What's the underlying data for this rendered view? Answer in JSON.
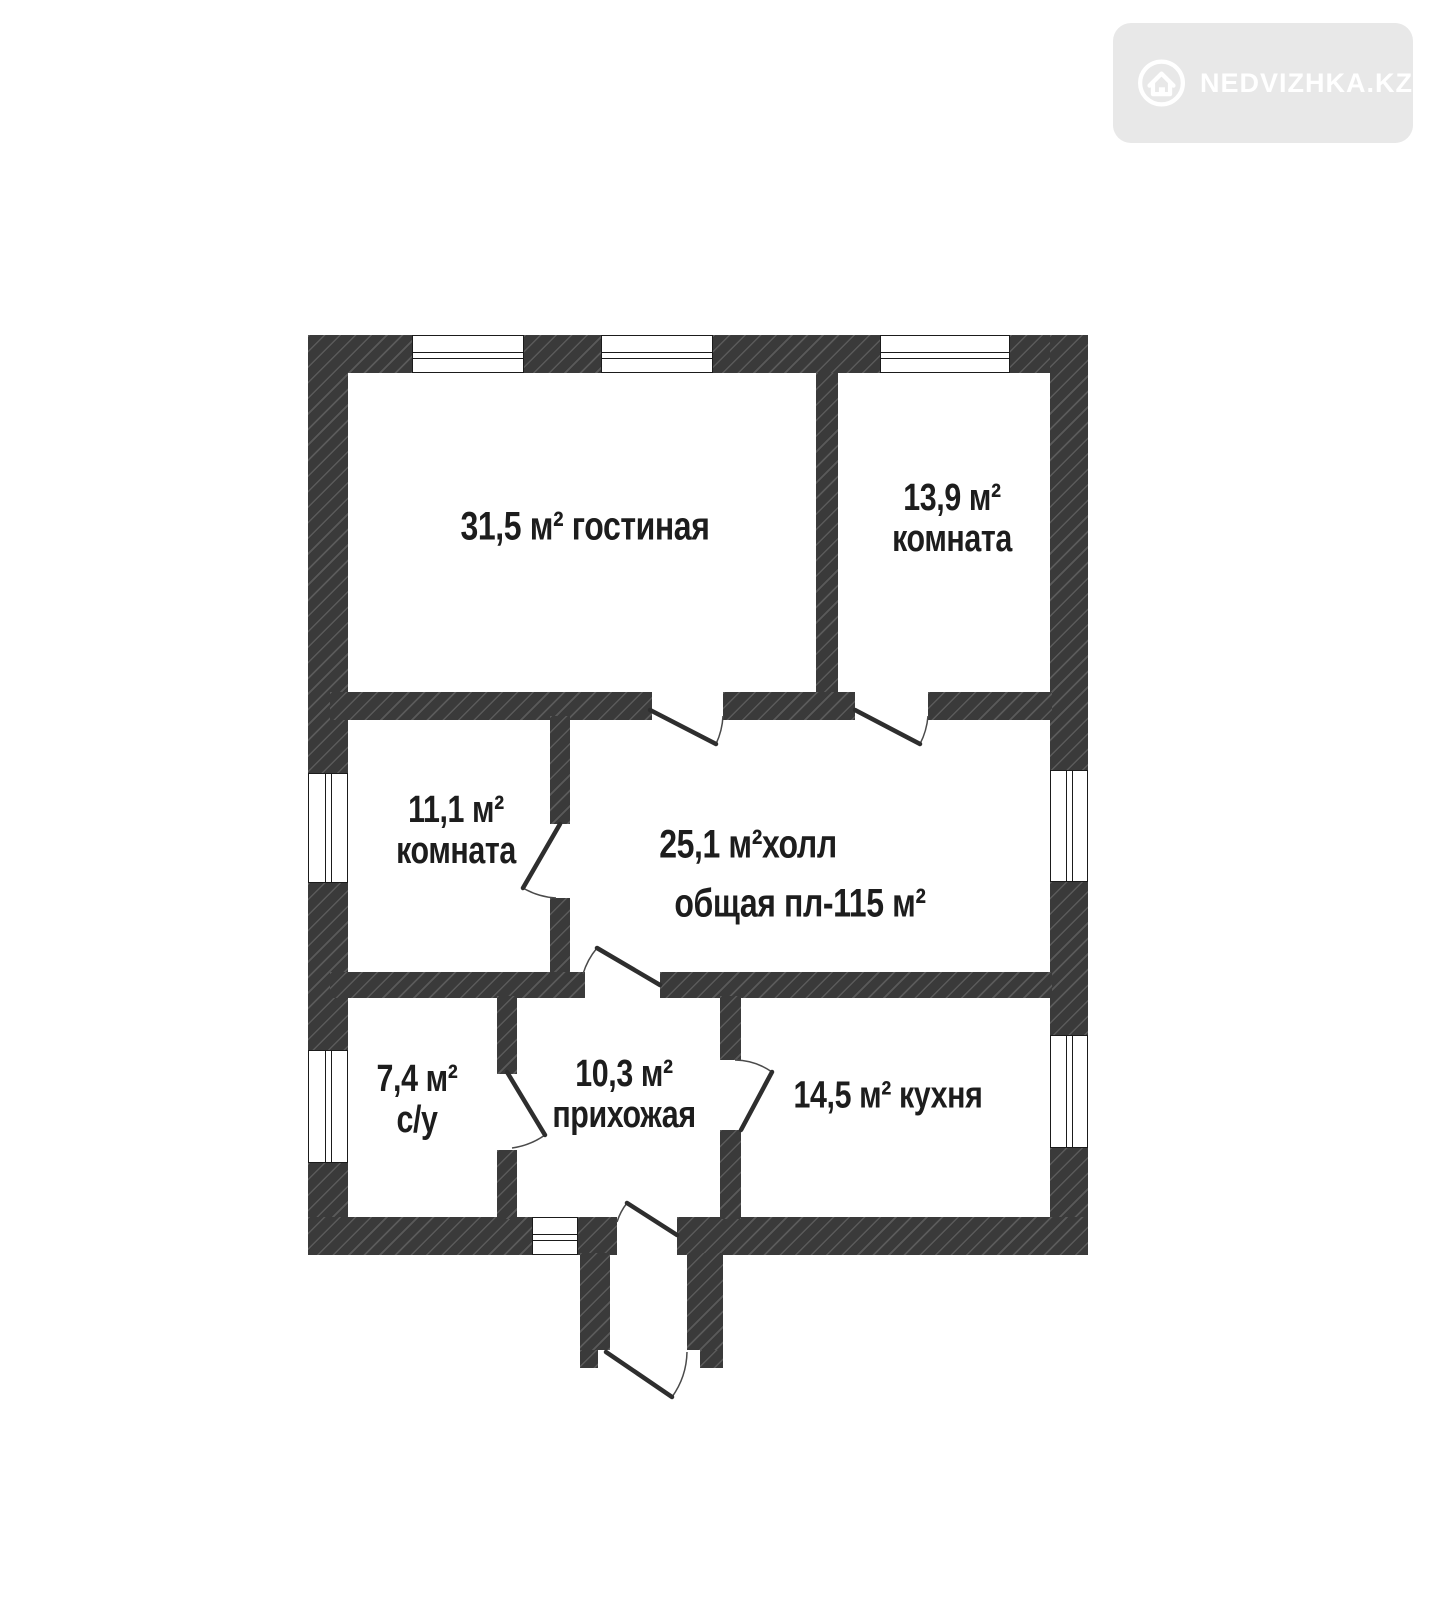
{
  "watermark": {
    "brand": "NEDVIZHKA.KZ",
    "bg_color": "#e8e8e8",
    "fg_color": "#ffffff"
  },
  "floor_plan": {
    "wall_color": "#3a3a3a",
    "total_area_text": "общая пл-115 м²",
    "rooms": [
      {
        "name": "гостиная",
        "area": "31,5 м²",
        "line1": "31,5 м² гостиная"
      },
      {
        "name": "комната",
        "area": "13,9 м²",
        "line1": "13,9 м²",
        "line2": "комната"
      },
      {
        "name": "комната",
        "area": "11,1 м²",
        "line1": "11,1 м²",
        "line2": "комната"
      },
      {
        "name": "холл",
        "area": "25,1 м²",
        "line1": "25,1 м²холл",
        "line2": "общая пл-115 м²"
      },
      {
        "name": "с/у",
        "area": "7,4 м²",
        "line1": "7,4 м²",
        "line2": "с/у"
      },
      {
        "name": "прихожая",
        "area": "10,3 м²",
        "line1": "10,3 м²",
        "line2": "прихожая"
      },
      {
        "name": "кухня",
        "area": "14,5 м²",
        "line1": "14,5 м² кухня"
      }
    ]
  }
}
